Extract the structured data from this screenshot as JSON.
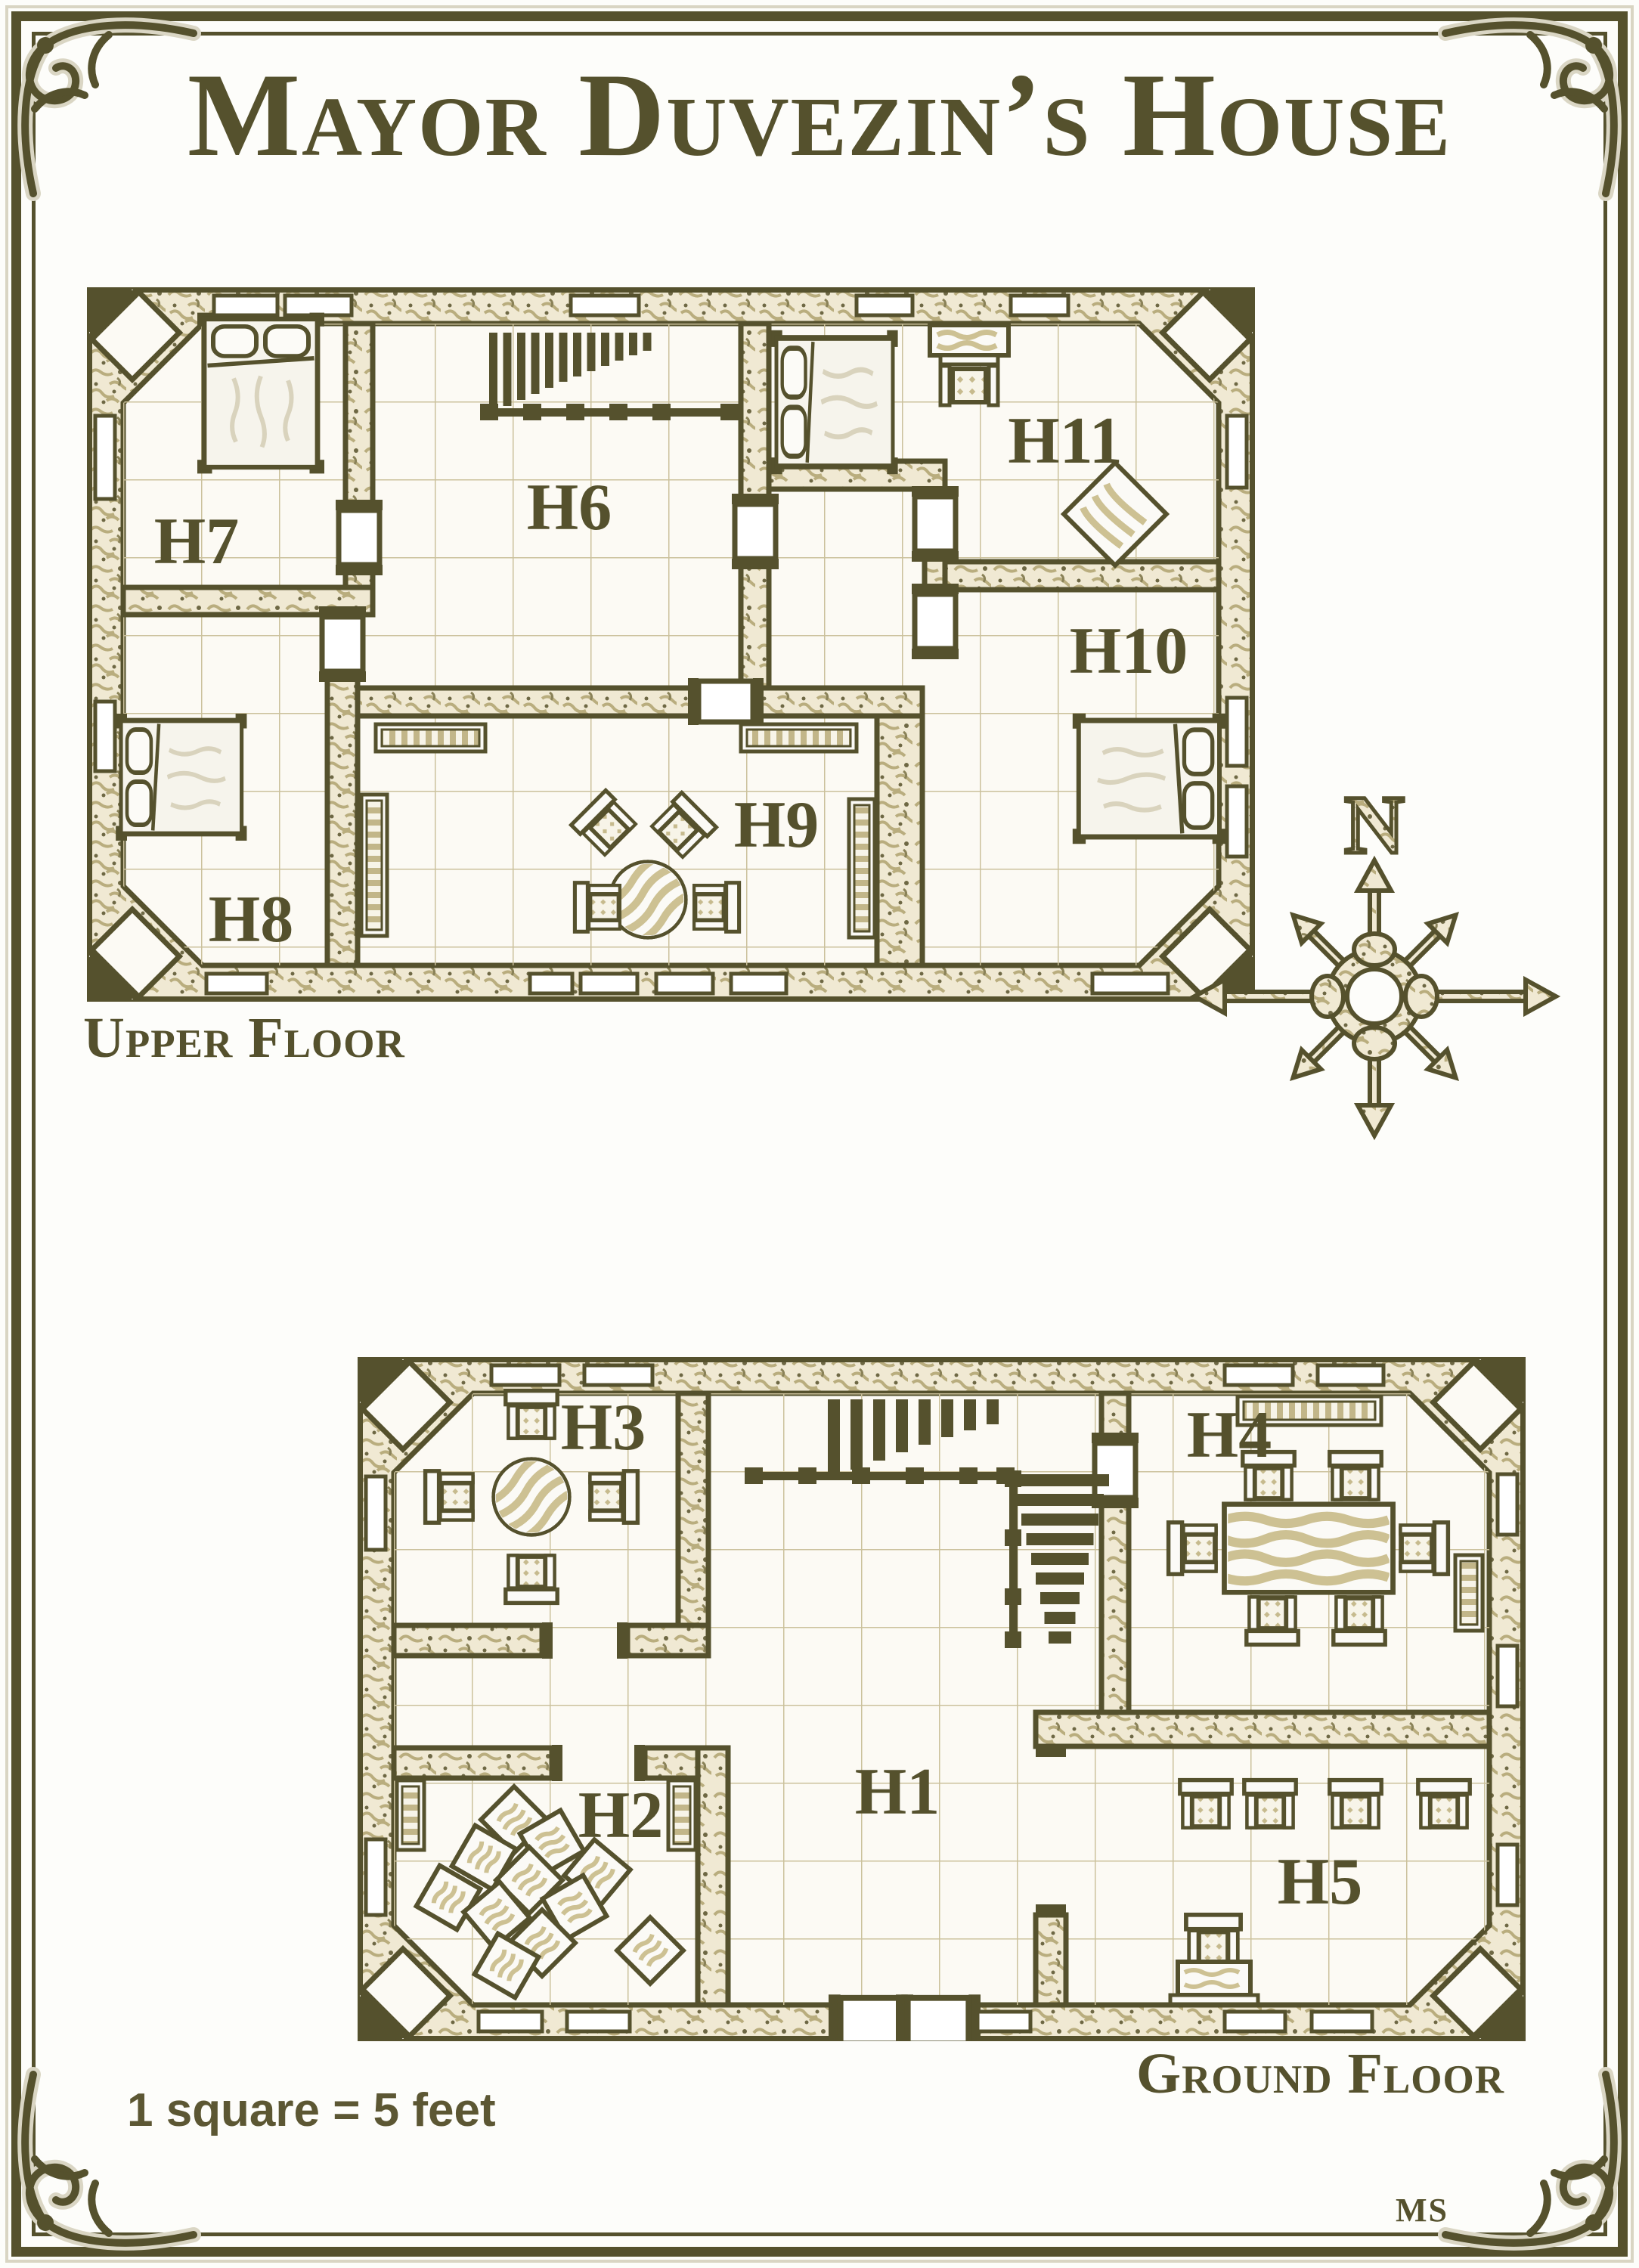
{
  "page": {
    "title": "Mayor Duvezin’s House",
    "scale_note": "1 square = 5 feet",
    "artist_monogram": "MS",
    "colors": {
      "ink": "#55512d",
      "parchment": "#fcfaf4",
      "wall_texture": "#b9ad7e",
      "grid": "#cbc19c",
      "wood": "#cdc193"
    }
  },
  "compass": {
    "north_label": "N"
  },
  "upper_floor": {
    "label": "Upper Floor",
    "rooms": [
      {
        "id": "H7",
        "label": "H7",
        "furniture": [
          "double-bed"
        ]
      },
      {
        "id": "H6",
        "label": "H6",
        "furniture": [
          "staircase",
          "railing"
        ]
      },
      {
        "id": "H8",
        "label": "H8",
        "furniture": [
          "double-bed"
        ]
      },
      {
        "id": "H9",
        "label": "H9",
        "furniture": [
          "round-table",
          "4-chairs",
          "bookshelves"
        ]
      },
      {
        "id": "H10",
        "label": "H10",
        "furniture": [
          "double-bed"
        ]
      },
      {
        "id": "H11",
        "label": "H11",
        "furniture": [
          "double-bed",
          "dresser-with-stool",
          "rug"
        ]
      }
    ]
  },
  "ground_floor": {
    "label": "Ground Floor",
    "rooms": [
      {
        "id": "H1",
        "label": "H1",
        "furniture": [
          "staircase-up",
          "staircase-down",
          "railings",
          "double-entrance-door"
        ]
      },
      {
        "id": "H2",
        "label": "H2",
        "furniture": [
          "scattered-crates",
          "shelves"
        ]
      },
      {
        "id": "H3",
        "label": "H3",
        "furniture": [
          "round-table",
          "4-chairs"
        ]
      },
      {
        "id": "H4",
        "label": "H4",
        "furniture": [
          "long-dining-table",
          "6-chairs",
          "sideboard",
          "shelf"
        ]
      },
      {
        "id": "H5",
        "label": "H5",
        "furniture": [
          "row-of-4-chairs",
          "writing-desk"
        ]
      }
    ]
  }
}
